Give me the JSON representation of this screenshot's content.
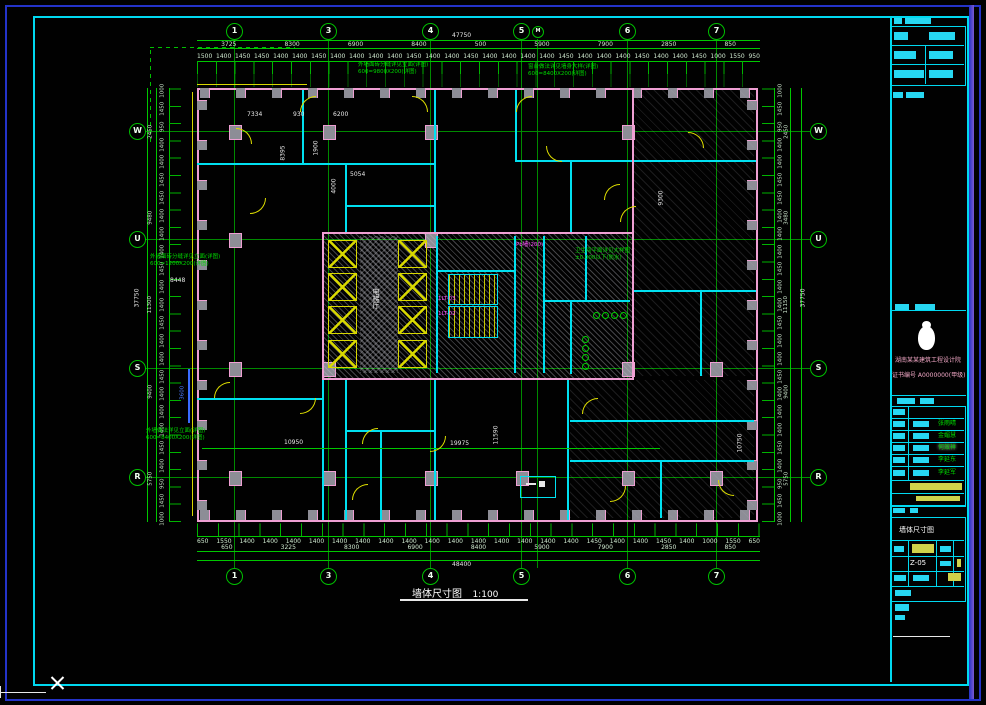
{
  "colors": {
    "accent_cyan": "#00d8f0",
    "grid_green": "#00c000",
    "wall_pink": "#ef9fd3",
    "dim_text": "#cfe8cf",
    "highlight_yellow": "#d8d800",
    "magenta": "#ff4fff",
    "frame_blue": "#2433c8"
  },
  "grid": {
    "top": [
      "1",
      "3",
      "4",
      "5",
      "M",
      "6",
      "7"
    ],
    "bottom": [
      "1",
      "3",
      "4",
      "5",
      "6",
      "7"
    ],
    "left": [
      "W",
      "U",
      "S",
      "R"
    ],
    "right": [
      "W",
      "U",
      "S",
      "R"
    ]
  },
  "dims": {
    "top_overall": "47750",
    "top_segments": [
      "3725",
      "8300",
      "6900",
      "8400",
      "500",
      "5900",
      "7900",
      "2850",
      "850"
    ],
    "top_ticks": [
      "1500",
      "1400",
      "1450",
      "1450",
      "1400",
      "1400",
      "1450",
      "1400",
      "1400",
      "1400",
      "1400",
      "1450",
      "1400",
      "1400",
      "1450",
      "1400",
      "1400",
      "1400",
      "1400",
      "1450",
      "1400",
      "1400",
      "1400",
      "1450",
      "1400",
      "1400",
      "1450",
      "1000",
      "1550",
      "950"
    ],
    "bottom_overall": "48400",
    "bottom_segments": [
      "650",
      "3225",
      "8300",
      "6900",
      "8400",
      "5900",
      "7900",
      "2850",
      "850"
    ],
    "bottom_ticks": [
      "650",
      "1550",
      "1400",
      "1400",
      "1400",
      "1400",
      "1400",
      "1400",
      "1400",
      "1400",
      "1400",
      "1400",
      "1400",
      "1400",
      "1400",
      "1400",
      "1400",
      "1450",
      "1400",
      "1400",
      "1450",
      "1400",
      "1000",
      "1550",
      "650"
    ],
    "left_overall": "37750",
    "left_segments": [
      "2450",
      "9480",
      "11300",
      "9400",
      "5750"
    ],
    "left_ticks": [
      "1000",
      "1450",
      "950",
      "1400",
      "1400",
      "1450",
      "1450",
      "1400",
      "1400",
      "1400",
      "1450",
      "1400",
      "1400",
      "1450",
      "1400",
      "1400",
      "1450",
      "1400",
      "1400",
      "1400",
      "1450",
      "1400",
      "950",
      "1450",
      "1000"
    ],
    "right_overall": "37750",
    "right_segments": [
      "2450",
      "3480",
      "11150",
      "9400",
      "5750"
    ],
    "right_ticks": [
      "1000",
      "1450",
      "950",
      "1400",
      "1400",
      "1450",
      "1450",
      "1400",
      "1400",
      "1400",
      "1450",
      "1400",
      "1400",
      "1450",
      "1400",
      "1400",
      "1450",
      "1400",
      "1400",
      "1400",
      "1450",
      "1400",
      "950",
      "1450",
      "1000"
    ]
  },
  "notes": {
    "n1a": "外墙面砖分缝详见立面(详图)",
    "n1b": "600=9800X200(详图)",
    "n2a": "窗台做法详见墙身大样(详图)",
    "n2b": "600=8400X200(详图)",
    "n3a": "外墙面砖分缝详见立面(详图)",
    "n3b": "600=1200X200(详图)",
    "n4a": "外墙做法详见立面(详图)",
    "n4b": "600=8400X200(详图)",
    "wc1": "卫生间平面详见大样图",
    "wc2": "±0.000以下(防水)"
  },
  "plan_labels": {
    "lobby": "电梯厅",
    "lt1": "1LT-03",
    "lt2": "1LT-02",
    "pwall": "Pb墙(200)",
    "d7334": "7334",
    "d930": "930",
    "d6200": "6200",
    "d8395": "8395",
    "d1900": "1900",
    "d5054": "5054",
    "d4000": "4000",
    "d8448": "8448",
    "d19975": "19975",
    "d11590": "11590",
    "d10950": "10950",
    "d10750": "10750",
    "d9300": "9300",
    "d3600": "3600"
  },
  "caption": {
    "title": "墙体尺寸图",
    "scale": "1:100"
  },
  "titleblock": {
    "company1": "湖南某某建筑工程设计院",
    "company2": "证书编号 A0000000(甲级)",
    "sig1": "张雨晴",
    "sig2": "金媚慧",
    "sig3": "何效祥",
    "sig4": "李延东",
    "sig5": "李延军",
    "drawing_title": "墙体尺寸图",
    "drawing_no": "Z-05"
  }
}
